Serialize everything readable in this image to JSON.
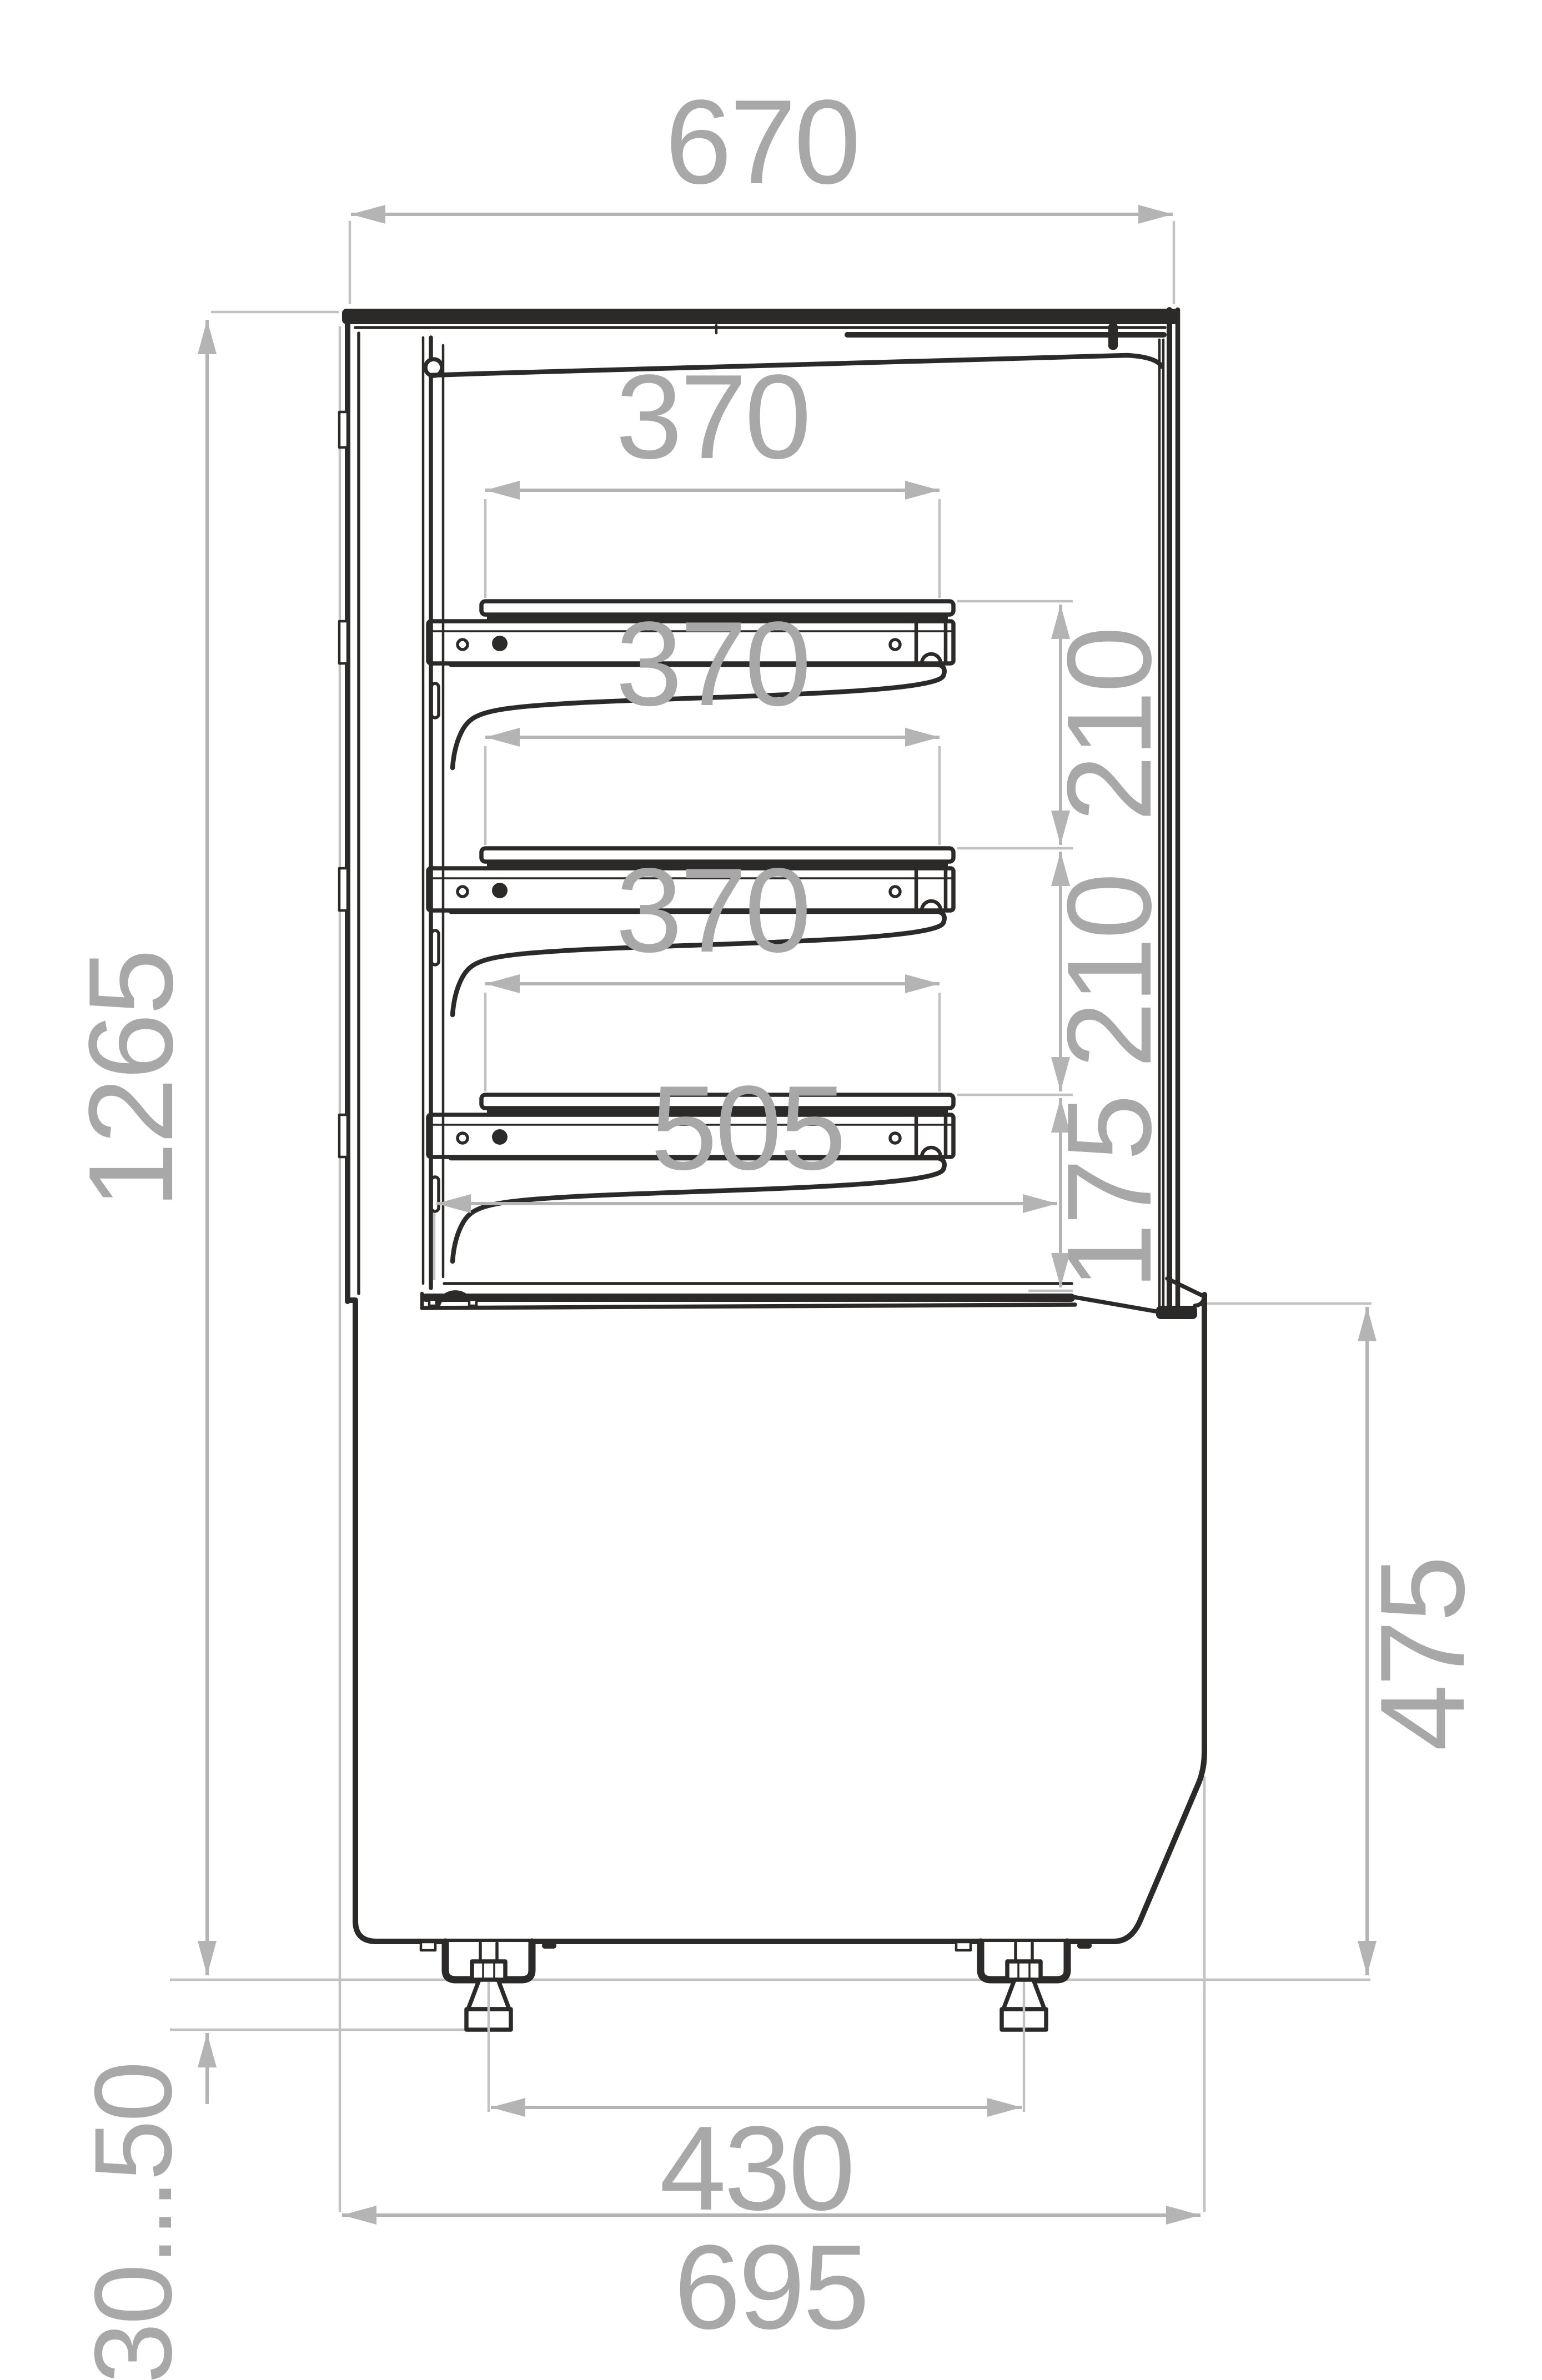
{
  "drawing": {
    "kind": "technical side-section drawing of a refrigerated display case",
    "units": "mm",
    "dims": {
      "top_width": "670",
      "overall_height": "1265",
      "shelf1_width": "370",
      "shelf2_width": "370",
      "shelf3_width": "370",
      "shelf_gap_1": "210",
      "shelf_gap_2": "210",
      "bottom_gap": "175",
      "floor_depth": "505",
      "base_height": "475",
      "leg_spacing": "430",
      "overall_depth": "695",
      "foot_adjust_range": "30...50"
    },
    "colors": {
      "line": "#2B2A29",
      "dimension_line": "#B4B4B4",
      "dimension_text": "#A8A8A8",
      "background": "#FFFFFF"
    }
  }
}
